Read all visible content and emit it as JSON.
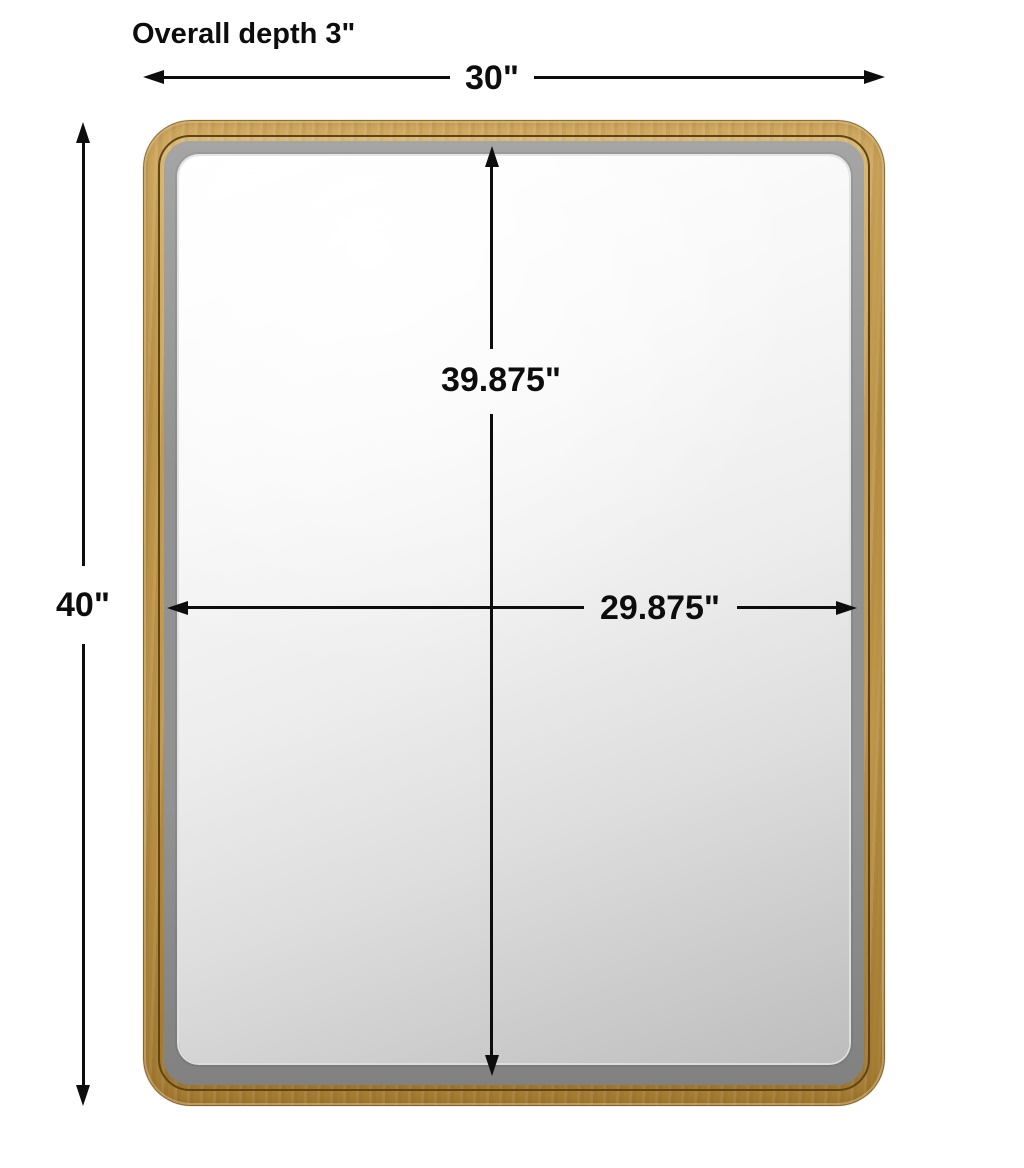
{
  "annotations": {
    "overall_depth": "Overall depth 3\"",
    "overall_width": "30\"",
    "overall_height": "40\"",
    "mirror_height": "39.875\"",
    "mirror_width": "29.875\""
  },
  "product": {
    "kind": "rounded-corner rectangular wall mirror with beveled glass and gold frame"
  },
  "style": {
    "colors": {
      "page_bg": "#ffffff",
      "ink": "#0d0d0d",
      "frame_gold_light": "#d3ac62",
      "frame_gold_mid": "#c0974a",
      "frame_gold_dark": "#a57c32",
      "frame_groove": "#5e4417",
      "bevel_gray_light": "#a5a5a5",
      "bevel_gray": "#929292",
      "bevel_gray_dark": "#818181",
      "mirror_light": "#ffffff",
      "mirror_dark": "#bdbdbd"
    }
  }
}
